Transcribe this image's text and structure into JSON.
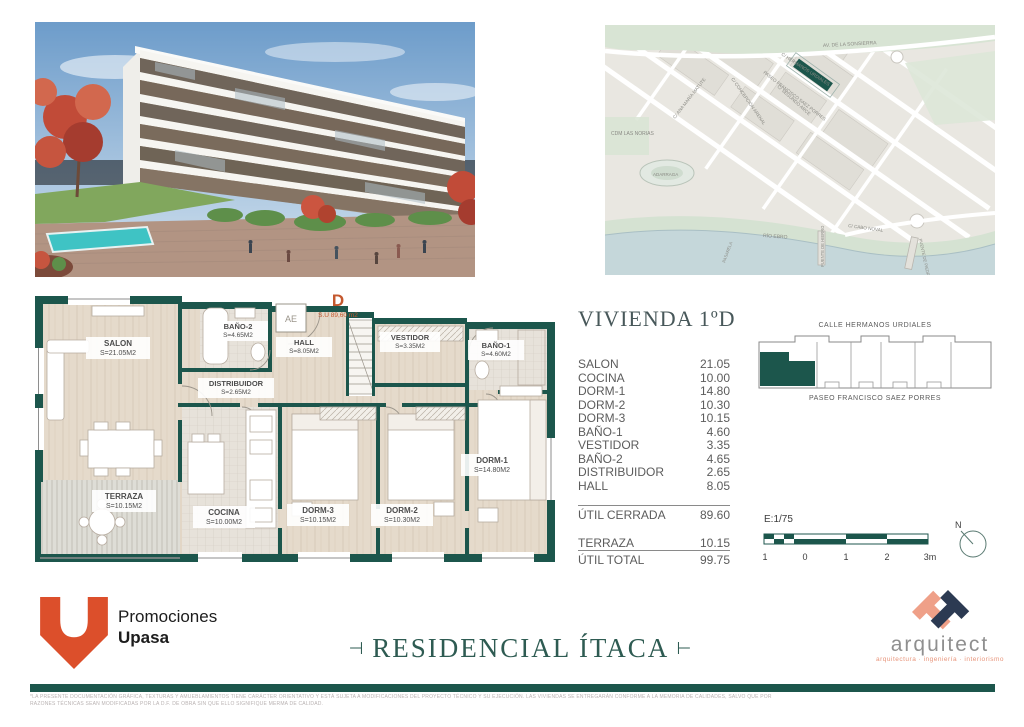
{
  "map": {
    "labels": [
      "AV. DE LA SONSIERRA",
      "C/ HERMANOS URDIALES",
      "PASEO FRANCISCO SAEZ PORRES",
      "C/ ANA MARÍA MATUTE",
      "C/ CONCEPCIÓN ARENAL",
      "C/ SEGUNDO ARCE",
      "CDM LAS NORIAS",
      "ADARRAGA",
      "RÍO EBRO",
      "C/ CABO NOVAL",
      "PUENTE DE HIERRO",
      "PUENTE DE PIEDRA",
      "PASARELA"
    ]
  },
  "plan": {
    "unit_letter": "D",
    "unit_area_note": "S.U 89,60 m2",
    "elevator_label": "AE",
    "rooms": [
      {
        "name": "SALON",
        "area": "S=21.05M2"
      },
      {
        "name": "TERRAZA",
        "area": "S=10.15M2"
      },
      {
        "name": "COCINA",
        "area": "S=10.00M2"
      },
      {
        "name": "DORM-3",
        "area": "S=10.15M2"
      },
      {
        "name": "DORM-2",
        "area": "S=10.30M2"
      },
      {
        "name": "DORM-1",
        "area": "S=14.80M2"
      },
      {
        "name": "BAÑO-2",
        "area": "S=4.65M2"
      },
      {
        "name": "DISTRIBUIDOR",
        "area": "S=2.65M2"
      },
      {
        "name": "HALL",
        "area": "S=8.05M2"
      },
      {
        "name": "VESTIDOR",
        "area": "S=3.35M2"
      },
      {
        "name": "BAÑO-1",
        "area": "S=4.60M2"
      }
    ]
  },
  "unit_info": {
    "title": "VIVIENDA 1ºD",
    "rows": [
      {
        "label": "SALON",
        "value": "21.05"
      },
      {
        "label": "COCINA",
        "value": "10.00"
      },
      {
        "label": "DORM-1",
        "value": "14.80"
      },
      {
        "label": "DORM-2",
        "value": "10.30"
      },
      {
        "label": "DORM-3",
        "value": "10.15"
      },
      {
        "label": "BAÑO-1",
        "value": "4.60"
      },
      {
        "label": "VESTIDOR",
        "value": "3.35"
      },
      {
        "label": "BAÑO-2",
        "value": "4.65"
      },
      {
        "label": "DISTRIBUIDOR",
        "value": "2.65"
      },
      {
        "label": "HALL",
        "value": "8.05"
      }
    ],
    "subtotal": {
      "label": "ÚTIL CERRADA",
      "value": "89.60"
    },
    "terrace": {
      "label": "TERRAZA",
      "value": "10.15"
    },
    "total": {
      "label": "ÚTIL TOTAL",
      "value": "99.75"
    }
  },
  "location": {
    "street_top": "CALLE HERMANOS URDIALES",
    "street_bottom": "PASEO FRANCISCO SAEZ PORRES"
  },
  "scale": {
    "label": "E:1/75",
    "ticks": [
      "1",
      "0",
      "1",
      "2",
      "3m"
    ],
    "north_label": "N"
  },
  "branding": {
    "promoter_line1": "Promociones",
    "promoter_line2": "Upasa",
    "ornament_left": "⊣",
    "ornament_right": "⊢",
    "project_title": "RESIDENCIAL ÍTACA",
    "architect_name": "arquitect",
    "architect_tagline": "arquitectura · ingeniería · interiorismo"
  },
  "footer": {
    "disclaimer_line1": "*LA PRESENTE DOCUMENTACIÓN GRÁFICA, TEXTURAS Y AMUEBLAMIENTOS TIENE CARÁCTER ORIENTATIVO Y ESTÁ SUJETA A MODIFICACIONES DEL PROYECTO TÉCNICO Y SU EJECUCIÓN. LAS VIVIENDAS SE ENTREGARÁN CONFORME A LA MEMORIA DE CALIDADES, SALVO QUE POR",
    "disclaimer_line2": "RAZONES TÉCNICAS SEAN MODIFICADAS POR LA D.F. DE OBRA SIN QUE ELLO SIGNIFIQUE MERMA DE CALIDAD."
  },
  "colors": {
    "teal": "#1c564c",
    "orange": "#dc4f2b",
    "salmon": "#efa088",
    "navy": "#2c3a52"
  }
}
